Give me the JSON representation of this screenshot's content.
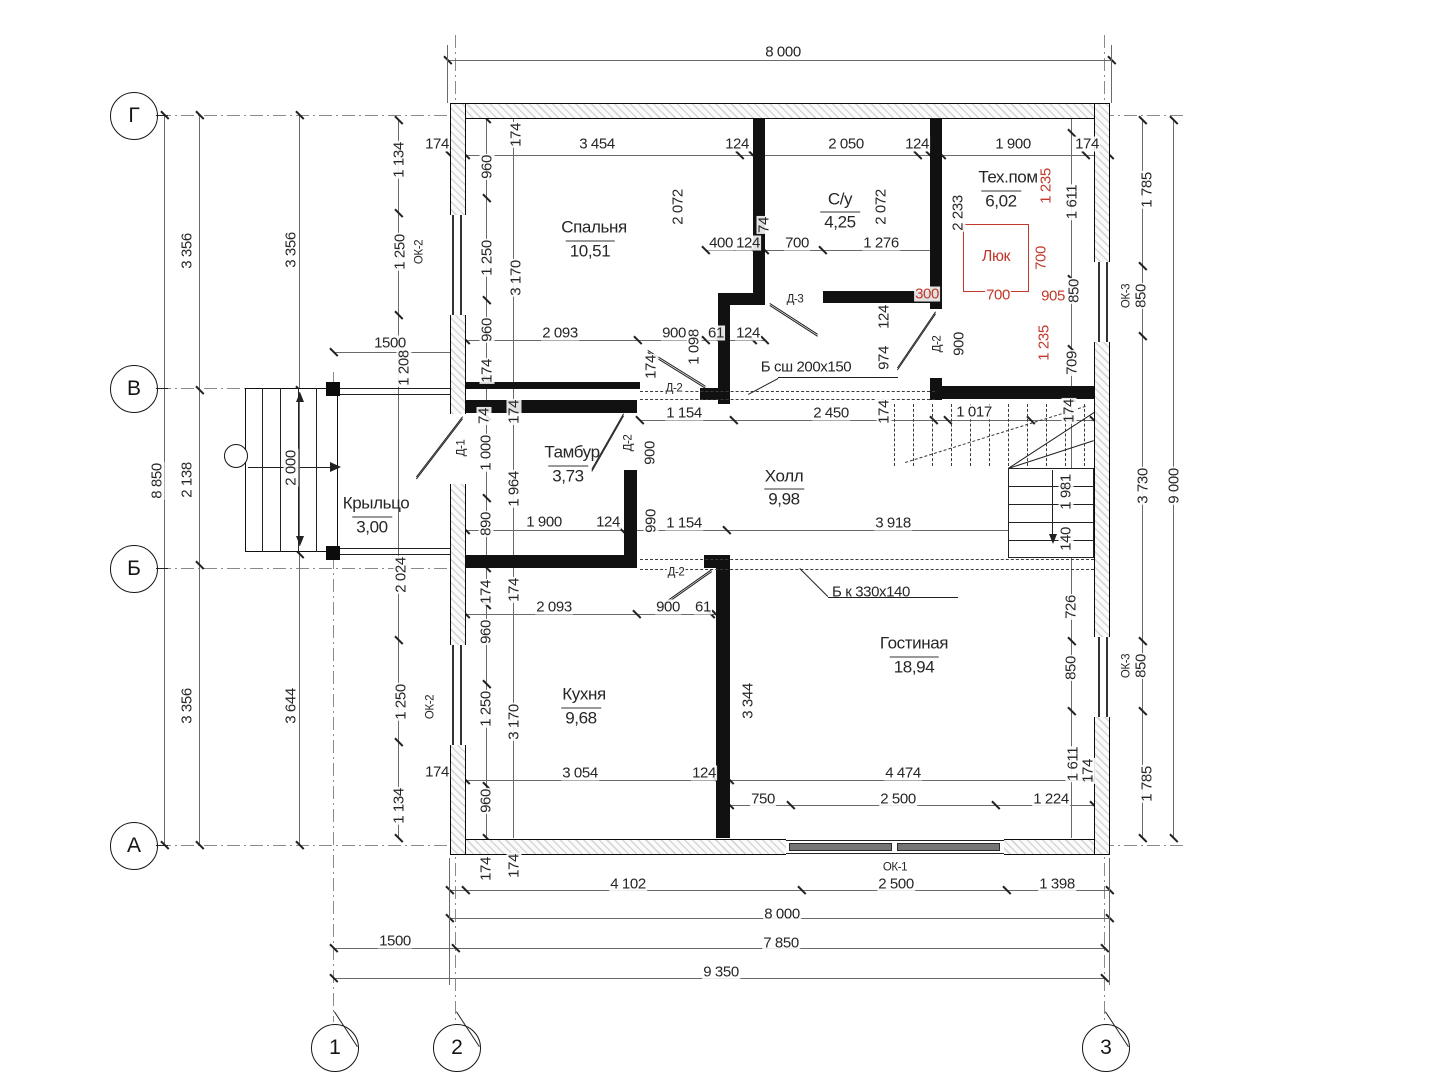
{
  "meta": {
    "kind": "architectural-floor-plan",
    "language": "ru"
  },
  "colors": {
    "accent_red": "#c0392b",
    "line_black": "#222222",
    "hatch_gray": "#d7d7d7"
  },
  "axes": {
    "rows": [
      {
        "label": "Г",
        "x": 133,
        "y": 115
      },
      {
        "label": "В",
        "x": 133,
        "y": 388
      },
      {
        "label": "Б",
        "x": 133,
        "y": 568
      },
      {
        "label": "А",
        "x": 133,
        "y": 845
      }
    ],
    "cols": [
      {
        "label": "1",
        "x": 334,
        "y": 1047
      },
      {
        "label": "2",
        "x": 456,
        "y": 1047
      },
      {
        "label": "3",
        "x": 1105,
        "y": 1047
      }
    ]
  },
  "rooms": [
    {
      "name": "Спальня",
      "area": "10,51"
    },
    {
      "name": "С/у",
      "area": "4,25"
    },
    {
      "name": "Тех.пом",
      "area": "6,02"
    },
    {
      "name": "Тамбур",
      "area": "3,73"
    },
    {
      "name": "Холл",
      "area": "9,98"
    },
    {
      "name": "Кухня",
      "area": "9,68"
    },
    {
      "name": "Гостиная",
      "area": "18,94"
    },
    {
      "name": "Крыльцо",
      "area": "3,00"
    }
  ],
  "openings": {
    "doors": [
      "Д-1",
      "Д-2",
      "Д-3"
    ],
    "windows": [
      "ОК-1",
      "ОК-2",
      "ОК-3"
    ],
    "roof_hatch": "Люк"
  },
  "beams": [
    "Б сш 200х150",
    "Б к 330х140"
  ],
  "overall_dimensions": {
    "top": "8 000",
    "bottom": "8 000",
    "left": "8 850",
    "right": "9 000",
    "row_2_3": "7 850",
    "row_1_2": "1500",
    "total": "9 350"
  },
  "labels": [
    {
      "t": "8 000",
      "x": 783,
      "y": 52,
      "o": "h",
      "k": "d"
    },
    {
      "t": "174",
      "x": 437,
      "y": 144,
      "o": "h",
      "k": "d"
    },
    {
      "t": "3 454",
      "x": 597,
      "y": 144,
      "o": "h",
      "k": "d"
    },
    {
      "t": "124",
      "x": 737,
      "y": 144,
      "o": "h",
      "k": "d"
    },
    {
      "t": "2 050",
      "x": 846,
      "y": 144,
      "o": "h",
      "k": "d"
    },
    {
      "t": "124",
      "x": 917,
      "y": 144,
      "o": "h",
      "k": "d"
    },
    {
      "t": "1 900",
      "x": 1013,
      "y": 144,
      "o": "h",
      "k": "d"
    },
    {
      "t": "174",
      "x": 1087,
      "y": 144,
      "o": "h",
      "k": "d"
    },
    {
      "t": "1 785",
      "x": 1147,
      "y": 190,
      "o": "v",
      "k": "d"
    },
    {
      "t": "1 134",
      "x": 399,
      "y": 160,
      "o": "v",
      "k": "d"
    },
    {
      "t": "960",
      "x": 487,
      "y": 167,
      "o": "v",
      "k": "d"
    },
    {
      "t": "174",
      "x": 516,
      "y": 135,
      "o": "v",
      "k": "d"
    },
    {
      "t": "ОК-2",
      "x": 420,
      "y": 252,
      "o": "v",
      "k": "t"
    },
    {
      "t": "1 250",
      "x": 400,
      "y": 252,
      "o": "v",
      "k": "d"
    },
    {
      "t": "1 250",
      "x": 487,
      "y": 258,
      "o": "v",
      "k": "d"
    },
    {
      "t": "3 170",
      "x": 516,
      "y": 278,
      "o": "v",
      "k": "d"
    },
    {
      "t": "960",
      "x": 487,
      "y": 330,
      "o": "v",
      "k": "d"
    },
    {
      "t": "174",
      "x": 487,
      "y": 371,
      "o": "v",
      "k": "d"
    },
    {
      "t": "Спальня",
      "x": 594,
      "y": 227,
      "o": "h",
      "k": "n"
    },
    {
      "t": "10,51",
      "x": 590,
      "y": 250,
      "o": "h",
      "k": "a"
    },
    {
      "t": "2 072",
      "x": 678,
      "y": 207,
      "o": "v",
      "k": "d"
    },
    {
      "t": "С/у",
      "x": 840,
      "y": 199,
      "o": "h",
      "k": "n"
    },
    {
      "t": "4,25",
      "x": 840,
      "y": 221,
      "o": "h",
      "k": "a"
    },
    {
      "t": "2 072",
      "x": 881,
      "y": 207,
      "o": "v",
      "k": "d"
    },
    {
      "t": "74",
      "x": 764,
      "y": 225,
      "o": "v",
      "k": "d"
    },
    {
      "t": "400",
      "x": 721,
      "y": 243,
      "o": "h",
      "k": "d"
    },
    {
      "t": "124",
      "x": 748,
      "y": 243,
      "o": "h",
      "k": "d"
    },
    {
      "t": "700",
      "x": 797,
      "y": 243,
      "o": "h",
      "k": "d"
    },
    {
      "t": "1 276",
      "x": 881,
      "y": 243,
      "o": "h",
      "k": "d"
    },
    {
      "t": "2 233",
      "x": 958,
      "y": 213,
      "o": "v",
      "k": "d"
    },
    {
      "t": "Тех.пом",
      "x": 1008,
      "y": 177,
      "o": "h",
      "k": "n"
    },
    {
      "t": "6,02",
      "x": 1001,
      "y": 200,
      "o": "h",
      "k": "a"
    },
    {
      "t": "1 235",
      "x": 1046,
      "y": 186,
      "o": "v",
      "k": "r"
    },
    {
      "t": "1 611",
      "x": 1072,
      "y": 202,
      "o": "v",
      "k": "d"
    },
    {
      "t": "Люк",
      "x": 996,
      "y": 257,
      "o": "h",
      "k": "rn"
    },
    {
      "t": "700",
      "x": 1041,
      "y": 258,
      "o": "v",
      "k": "r"
    },
    {
      "t": "700",
      "x": 998,
      "y": 295,
      "o": "h",
      "k": "r"
    },
    {
      "t": "905",
      "x": 1053,
      "y": 296,
      "o": "h",
      "k": "r"
    },
    {
      "t": "850",
      "x": 1074,
      "y": 291,
      "o": "v",
      "k": "d"
    },
    {
      "t": "1 235",
      "x": 1044,
      "y": 343,
      "o": "v",
      "k": "r"
    },
    {
      "t": "709",
      "x": 1072,
      "y": 363,
      "o": "v",
      "k": "d"
    },
    {
      "t": "ОК-3",
      "x": 1127,
      "y": 296,
      "o": "v",
      "k": "t"
    },
    {
      "t": "850",
      "x": 1141,
      "y": 296,
      "o": "v",
      "k": "d"
    },
    {
      "t": "300",
      "x": 927,
      "y": 294,
      "o": "h",
      "k": "r"
    },
    {
      "t": "Д-3",
      "x": 795,
      "y": 300,
      "o": "h",
      "k": "t"
    },
    {
      "t": "Д-2",
      "x": 938,
      "y": 344,
      "o": "v",
      "k": "t"
    },
    {
      "t": "900",
      "x": 959,
      "y": 344,
      "o": "v",
      "k": "d"
    },
    {
      "t": "124",
      "x": 884,
      "y": 317,
      "o": "v",
      "k": "d"
    },
    {
      "t": "974",
      "x": 884,
      "y": 358,
      "o": "v",
      "k": "d"
    },
    {
      "t": "2 093",
      "x": 560,
      "y": 333,
      "o": "h",
      "k": "d"
    },
    {
      "t": "900",
      "x": 674,
      "y": 333,
      "o": "h",
      "k": "d"
    },
    {
      "t": "1 098",
      "x": 694,
      "y": 347,
      "o": "v",
      "k": "d"
    },
    {
      "t": "61",
      "x": 716,
      "y": 333,
      "o": "h",
      "k": "d"
    },
    {
      "t": "124",
      "x": 748,
      "y": 333,
      "o": "h",
      "k": "d"
    },
    {
      "t": "174",
      "x": 651,
      "y": 367,
      "o": "v",
      "k": "d"
    },
    {
      "t": "Д-2",
      "x": 674,
      "y": 389,
      "o": "h",
      "k": "t"
    },
    {
      "t": "Б сш 200х150",
      "x": 806,
      "y": 367,
      "o": "h",
      "k": "t2"
    },
    {
      "t": "1500",
      "x": 390,
      "y": 343,
      "o": "h",
      "k": "d"
    },
    {
      "t": "1 208",
      "x": 404,
      "y": 368,
      "o": "v",
      "k": "d"
    },
    {
      "t": "74",
      "x": 484,
      "y": 416,
      "o": "v",
      "k": "d"
    },
    {
      "t": "174",
      "x": 514,
      "y": 412,
      "o": "v",
      "k": "d"
    },
    {
      "t": "Д-1",
      "x": 462,
      "y": 448,
      "o": "v",
      "k": "t"
    },
    {
      "t": "1 000",
      "x": 486,
      "y": 453,
      "o": "v",
      "k": "d"
    },
    {
      "t": "1 964",
      "x": 514,
      "y": 489,
      "o": "v",
      "k": "d"
    },
    {
      "t": "Тамбур",
      "x": 572,
      "y": 452,
      "o": "h",
      "k": "n"
    },
    {
      "t": "3,73",
      "x": 568,
      "y": 475,
      "o": "h",
      "k": "a"
    },
    {
      "t": "Д-2",
      "x": 629,
      "y": 443,
      "o": "v",
      "k": "t"
    },
    {
      "t": "900",
      "x": 650,
      "y": 453,
      "o": "v",
      "k": "d"
    },
    {
      "t": "1 154",
      "x": 684,
      "y": 413,
      "o": "h",
      "k": "d"
    },
    {
      "t": "2 450",
      "x": 831,
      "y": 413,
      "o": "h",
      "k": "d"
    },
    {
      "t": "174",
      "x": 884,
      "y": 412,
      "o": "v",
      "k": "d"
    },
    {
      "t": "1 017",
      "x": 974,
      "y": 412,
      "o": "h",
      "k": "d"
    },
    {
      "t": "174",
      "x": 1069,
      "y": 411,
      "o": "v",
      "k": "d"
    },
    {
      "t": "Холл",
      "x": 784,
      "y": 476,
      "o": "h",
      "k": "n"
    },
    {
      "t": "9,98",
      "x": 784,
      "y": 498,
      "o": "h",
      "k": "a"
    },
    {
      "t": "Крыльцо",
      "x": 376,
      "y": 503,
      "o": "h",
      "k": "n"
    },
    {
      "t": "3,00",
      "x": 372,
      "y": 526,
      "o": "h",
      "k": "a"
    },
    {
      "t": "2 000",
      "x": 291,
      "y": 468,
      "o": "v",
      "k": "d"
    },
    {
      "t": "8 850",
      "x": 157,
      "y": 481,
      "o": "v",
      "k": "d"
    },
    {
      "t": "2 138",
      "x": 187,
      "y": 480,
      "o": "v",
      "k": "d"
    },
    {
      "t": "3 356",
      "x": 187,
      "y": 251,
      "o": "v",
      "k": "d"
    },
    {
      "t": "3 356",
      "x": 291,
      "y": 250,
      "o": "v",
      "k": "d"
    },
    {
      "t": "3 356",
      "x": 187,
      "y": 706,
      "o": "v",
      "k": "d"
    },
    {
      "t": "3 644",
      "x": 291,
      "y": 706,
      "o": "v",
      "k": "d"
    },
    {
      "t": "890",
      "x": 486,
      "y": 524,
      "o": "v",
      "k": "d"
    },
    {
      "t": "1 900",
      "x": 544,
      "y": 522,
      "o": "h",
      "k": "d"
    },
    {
      "t": "124",
      "x": 608,
      "y": 522,
      "o": "h",
      "k": "d"
    },
    {
      "t": "990",
      "x": 651,
      "y": 521,
      "o": "v",
      "k": "d"
    },
    {
      "t": "1 154",
      "x": 684,
      "y": 523,
      "o": "h",
      "k": "d"
    },
    {
      "t": "3 918",
      "x": 893,
      "y": 523,
      "o": "h",
      "k": "d"
    },
    {
      "t": "1 981",
      "x": 1066,
      "y": 492,
      "o": "v",
      "k": "d"
    },
    {
      "t": "140",
      "x": 1066,
      "y": 539,
      "o": "v",
      "k": "d"
    },
    {
      "t": "3 730",
      "x": 1143,
      "y": 486,
      "o": "v",
      "k": "d"
    },
    {
      "t": "9 000",
      "x": 1174,
      "y": 486,
      "o": "v",
      "k": "d"
    },
    {
      "t": "2 024",
      "x": 401,
      "y": 575,
      "o": "v",
      "k": "d"
    },
    {
      "t": "Б к 330х140",
      "x": 871,
      "y": 592,
      "o": "h",
      "k": "t2"
    },
    {
      "t": "Д-2",
      "x": 676,
      "y": 573,
      "o": "h",
      "k": "t"
    },
    {
      "t": "174",
      "x": 486,
      "y": 592,
      "o": "v",
      "k": "d"
    },
    {
      "t": "174",
      "x": 514,
      "y": 590,
      "o": "v",
      "k": "d"
    },
    {
      "t": "2 093",
      "x": 554,
      "y": 607,
      "o": "h",
      "k": "d"
    },
    {
      "t": "900",
      "x": 668,
      "y": 607,
      "o": "h",
      "k": "d"
    },
    {
      "t": "61",
      "x": 703,
      "y": 607,
      "o": "h",
      "k": "d"
    },
    {
      "t": "726",
      "x": 1071,
      "y": 607,
      "o": "v",
      "k": "d"
    },
    {
      "t": "960",
      "x": 486,
      "y": 632,
      "o": "v",
      "k": "d"
    },
    {
      "t": "1 250",
      "x": 486,
      "y": 709,
      "o": "v",
      "k": "d"
    },
    {
      "t": "3 170",
      "x": 514,
      "y": 722,
      "o": "v",
      "k": "d"
    },
    {
      "t": "ОК-2",
      "x": 431,
      "y": 707,
      "o": "v",
      "k": "t"
    },
    {
      "t": "1 250",
      "x": 401,
      "y": 702,
      "o": "v",
      "k": "d"
    },
    {
      "t": "Кухня",
      "x": 584,
      "y": 694,
      "o": "h",
      "k": "n"
    },
    {
      "t": "9,68",
      "x": 581,
      "y": 717,
      "o": "h",
      "k": "a"
    },
    {
      "t": "3 344",
      "x": 748,
      "y": 701,
      "o": "v",
      "k": "d"
    },
    {
      "t": "Гостиная",
      "x": 914,
      "y": 643,
      "o": "h",
      "k": "n"
    },
    {
      "t": "18,94",
      "x": 914,
      "y": 666,
      "o": "h",
      "k": "a"
    },
    {
      "t": "850",
      "x": 1071,
      "y": 668,
      "o": "v",
      "k": "d"
    },
    {
      "t": "ОК-3",
      "x": 1127,
      "y": 666,
      "o": "v",
      "k": "t"
    },
    {
      "t": "850",
      "x": 1141,
      "y": 666,
      "o": "v",
      "k": "d"
    },
    {
      "t": "3 054",
      "x": 580,
      "y": 773,
      "o": "h",
      "k": "d"
    },
    {
      "t": "124",
      "x": 704,
      "y": 773,
      "o": "h",
      "k": "d"
    },
    {
      "t": "4 474",
      "x": 903,
      "y": 773,
      "o": "h",
      "k": "d"
    },
    {
      "t": "1 611",
      "x": 1073,
      "y": 764,
      "o": "v",
      "k": "d"
    },
    {
      "t": "174",
      "x": 1088,
      "y": 771,
      "o": "v",
      "k": "d"
    },
    {
      "t": "960",
      "x": 486,
      "y": 801,
      "o": "v",
      "k": "d"
    },
    {
      "t": "1 134",
      "x": 399,
      "y": 806,
      "o": "v",
      "k": "d"
    },
    {
      "t": "174",
      "x": 437,
      "y": 772,
      "o": "h",
      "k": "d"
    },
    {
      "t": "750",
      "x": 763,
      "y": 799,
      "o": "h",
      "k": "d"
    },
    {
      "t": "2 500",
      "x": 898,
      "y": 799,
      "o": "h",
      "k": "d"
    },
    {
      "t": "1 224",
      "x": 1051,
      "y": 799,
      "o": "h",
      "k": "d"
    },
    {
      "t": "1 785",
      "x": 1147,
      "y": 784,
      "o": "v",
      "k": "d"
    },
    {
      "t": "174",
      "x": 514,
      "y": 866,
      "o": "v",
      "k": "d"
    },
    {
      "t": "174",
      "x": 486,
      "y": 869,
      "o": "v",
      "k": "d"
    },
    {
      "t": "4 102",
      "x": 628,
      "y": 884,
      "o": "h",
      "k": "d"
    },
    {
      "t": "ОК-1",
      "x": 895,
      "y": 868,
      "o": "h",
      "k": "t"
    },
    {
      "t": "2 500",
      "x": 896,
      "y": 884,
      "o": "h",
      "k": "d"
    },
    {
      "t": "1 398",
      "x": 1057,
      "y": 884,
      "o": "h",
      "k": "d"
    },
    {
      "t": "8 000",
      "x": 782,
      "y": 914,
      "o": "h",
      "k": "d"
    },
    {
      "t": "1500",
      "x": 395,
      "y": 941,
      "o": "h",
      "k": "d"
    },
    {
      "t": "7 850",
      "x": 781,
      "y": 943,
      "o": "h",
      "k": "d"
    },
    {
      "t": "9 350",
      "x": 721,
      "y": 972,
      "o": "h",
      "k": "d"
    }
  ]
}
